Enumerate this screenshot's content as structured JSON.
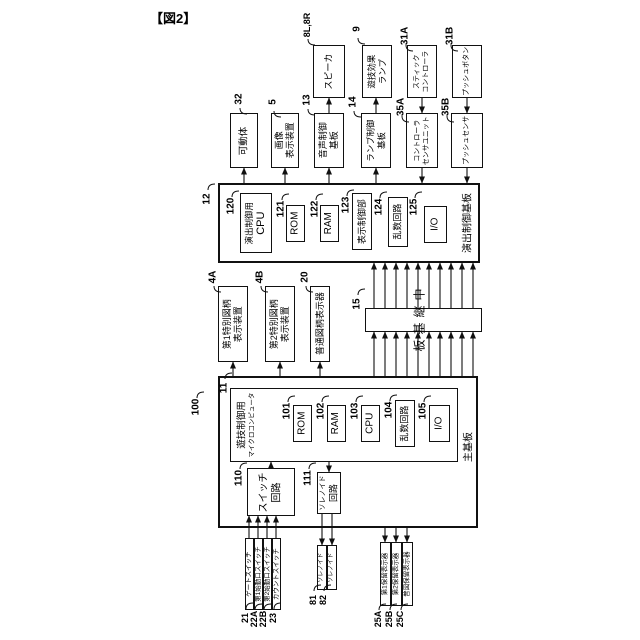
{
  "title": "【図2】",
  "nodes": {
    "movable_body": {
      "ref": "32",
      "label": "可動体"
    },
    "image_display": {
      "ref": "5",
      "line1": "画像",
      "line2": "表示装置"
    },
    "sound_board": {
      "ref": "13",
      "line1": "音声制御",
      "line2": "基板"
    },
    "speaker": {
      "ref": "8L,8R",
      "label": "スピーカ"
    },
    "lamp_board": {
      "ref": "14",
      "line1": "ランプ制御",
      "line2": "基板"
    },
    "effect_lamp": {
      "ref": "9",
      "line1": "遊技効果",
      "line2": "ランプ"
    },
    "controller_sensor": {
      "ref": "35A",
      "line1": "コントローラ",
      "line2": "センサユニット"
    },
    "stick_controller": {
      "ref": "31A",
      "line1": "スティック",
      "line2": "コントローラ"
    },
    "push_sensor": {
      "ref": "35B",
      "label": "プッシュセンサ"
    },
    "push_button": {
      "ref": "31B",
      "label": "プッシュボタン"
    },
    "effect_control_board": {
      "ref": "12",
      "label": "演出制御基板"
    },
    "effect_cpu": {
      "ref": "120",
      "line1": "演出制御用",
      "line2": "CPU"
    },
    "effect_rom": {
      "ref": "121",
      "label": "ROM"
    },
    "effect_ram": {
      "ref": "122",
      "label": "RAM"
    },
    "display_control": {
      "ref": "123",
      "label": "表示制御部"
    },
    "effect_random": {
      "ref": "124",
      "label": "乱数回路"
    },
    "effect_io": {
      "ref": "125",
      "label": "I/O"
    },
    "special1_display": {
      "ref": "4A",
      "line1": "第1特別図柄",
      "line2": "表示装置"
    },
    "special2_display": {
      "ref": "4B",
      "line1": "第2特別図柄",
      "line2": "表示装置"
    },
    "normal_display": {
      "ref": "20",
      "label": "普通図柄表示器"
    },
    "relay_board": {
      "ref": "15",
      "label": "中継基板"
    },
    "main_board": {
      "ref": "11",
      "label": "主基板"
    },
    "game_micro": {
      "ref": "100",
      "line1": "遊技制御用",
      "line2": "マイクロコンピュータ"
    },
    "main_rom": {
      "ref": "101",
      "label": "ROM"
    },
    "main_ram": {
      "ref": "102",
      "label": "RAM"
    },
    "main_cpu": {
      "ref": "103",
      "label": "CPU"
    },
    "main_random": {
      "ref": "104",
      "label": "乱数回路"
    },
    "main_io": {
      "ref": "105",
      "label": "I/O"
    },
    "switch_circuit": {
      "ref": "110",
      "line1": "スイッチ",
      "line2": "回路"
    },
    "solenoid_circuit": {
      "ref": "111",
      "line1": "ソレノイド",
      "line2": "回路"
    },
    "gate_switch": {
      "ref": "21",
      "label": "ゲートスイッチ"
    },
    "start1_switch": {
      "ref": "22A",
      "label": "第1始動口スイッチ"
    },
    "start2_switch": {
      "ref": "22B",
      "label": "第2始動口スイッチ"
    },
    "count_switch": {
      "ref": "23",
      "label": "カウントスイッチ"
    },
    "solenoid1": {
      "ref": "81",
      "label": "ソレノイド"
    },
    "solenoid2": {
      "ref": "82",
      "label": "ソレノイド"
    },
    "hold1_display": {
      "ref": "25A",
      "label": "第1保留表示器"
    },
    "hold2_display": {
      "ref": "25B",
      "label": "第2保留表示器"
    },
    "normal_hold_display": {
      "ref": "25C",
      "label": "普図保留表示器"
    }
  }
}
